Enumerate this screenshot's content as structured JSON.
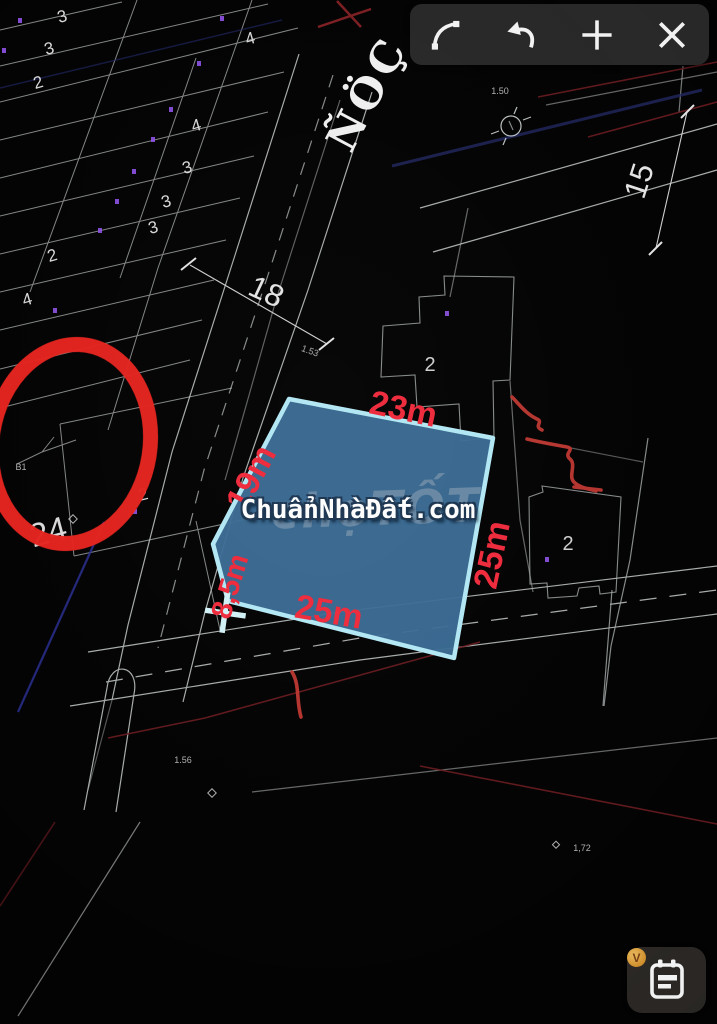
{
  "toolbar": {
    "icons": [
      "arc-tool-icon",
      "undo-icon",
      "plus-icon",
      "close-icon"
    ]
  },
  "street": {
    "name": "ÑÖÇ"
  },
  "parcel": {
    "fill_color": "#3b6c95",
    "border_color": "#b2e7f3",
    "dimension_color": "#ee2b3c",
    "dimensions": [
      "23m",
      "19m",
      "8,5m",
      "25m",
      "25m"
    ]
  },
  "road_dimensions": [
    "18",
    "15"
  ],
  "lot_numbers": [
    "3",
    "3",
    "2",
    "4",
    "4",
    "3",
    "3",
    "3",
    "2",
    "4",
    "2",
    "24",
    "2",
    "2"
  ],
  "small_marks": [
    "1.50",
    "1.53",
    "1.56",
    "B1",
    "1,72"
  ],
  "watermark": {
    "primary": "ChuẩnNhàĐất.com",
    "secondary": "chợTỐT"
  },
  "annotation": {
    "color": "#e5231e"
  },
  "fab": {
    "badge": "V"
  }
}
